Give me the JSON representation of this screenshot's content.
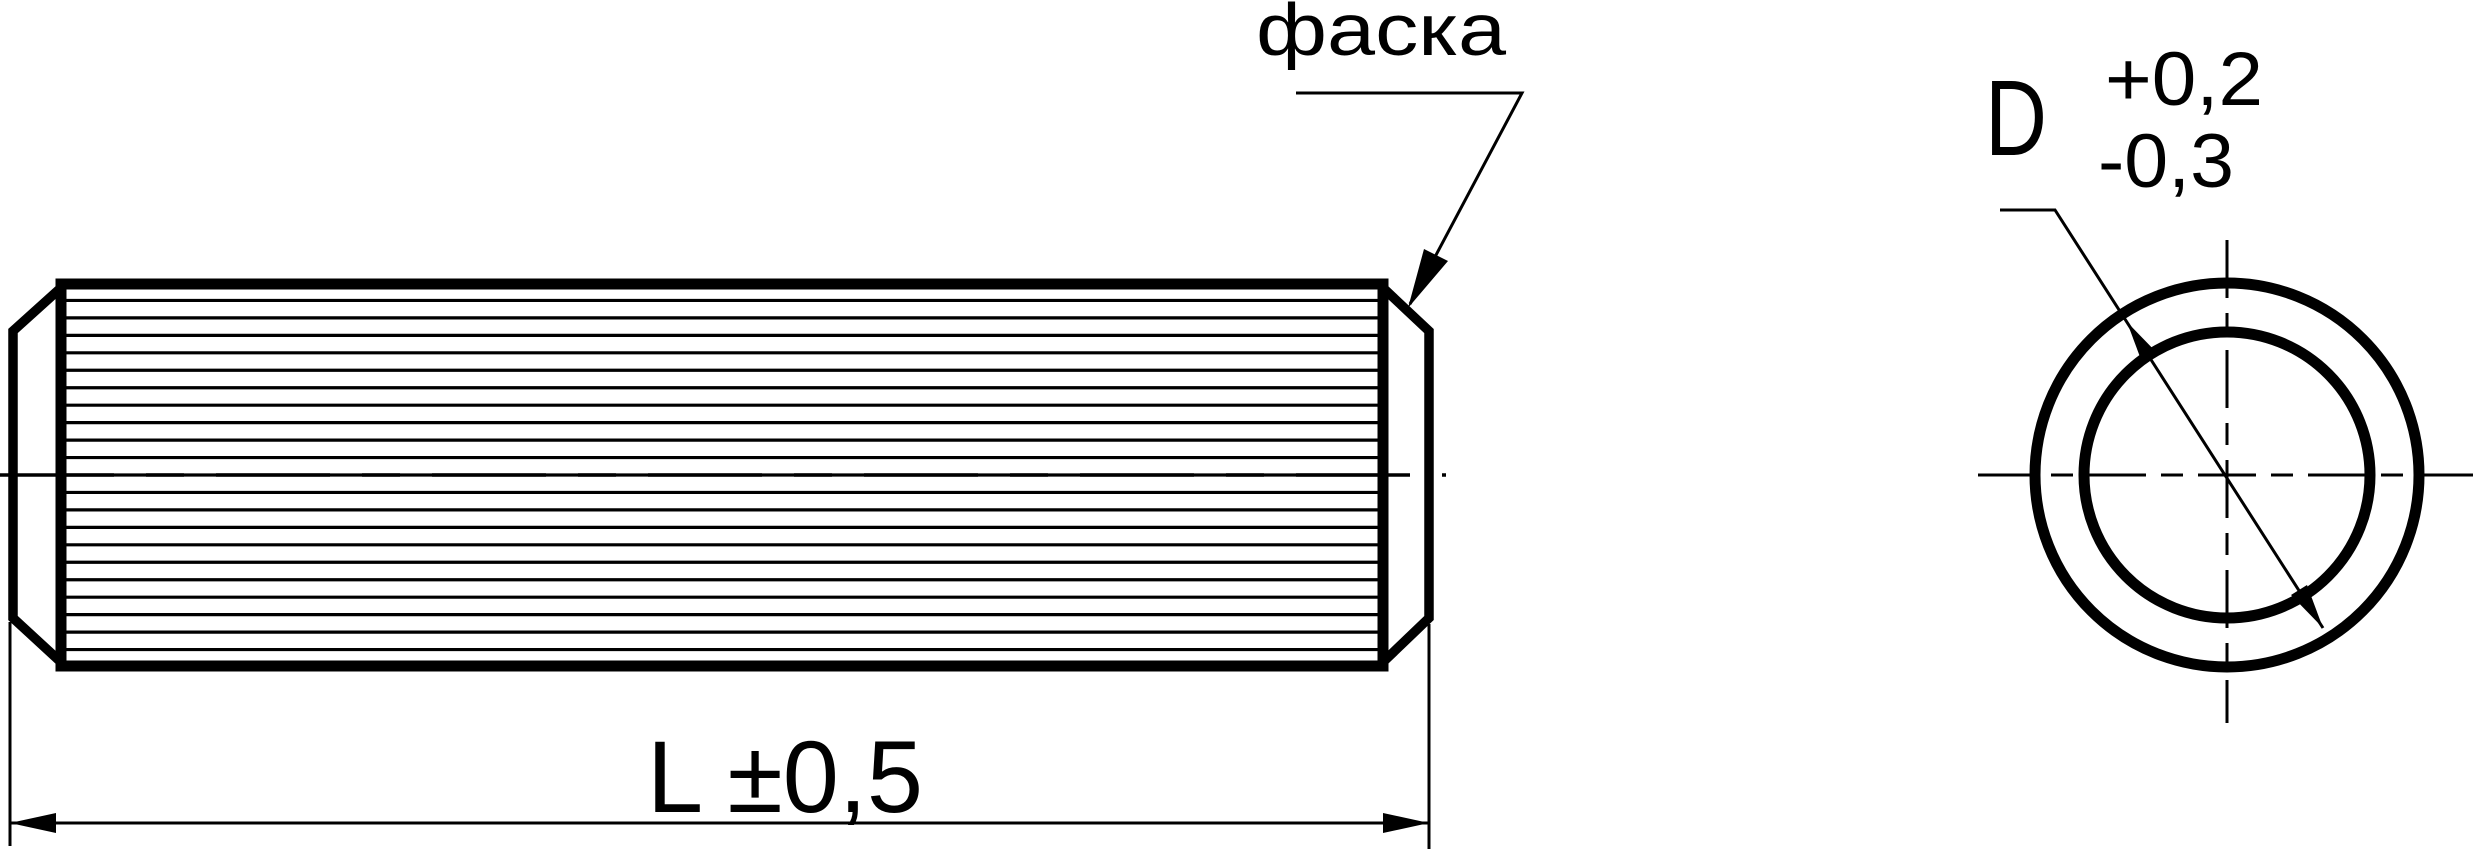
{
  "drawing": {
    "colors": {
      "line": "#000000",
      "background": "#ffffff"
    },
    "side_view": {
      "chamfer_callout": "фаска",
      "length_dimension": "L ±0,5"
    },
    "end_view": {
      "diameter_label": "D",
      "tolerance_upper": "+0,2",
      "tolerance_lower": "-0,3"
    }
  }
}
